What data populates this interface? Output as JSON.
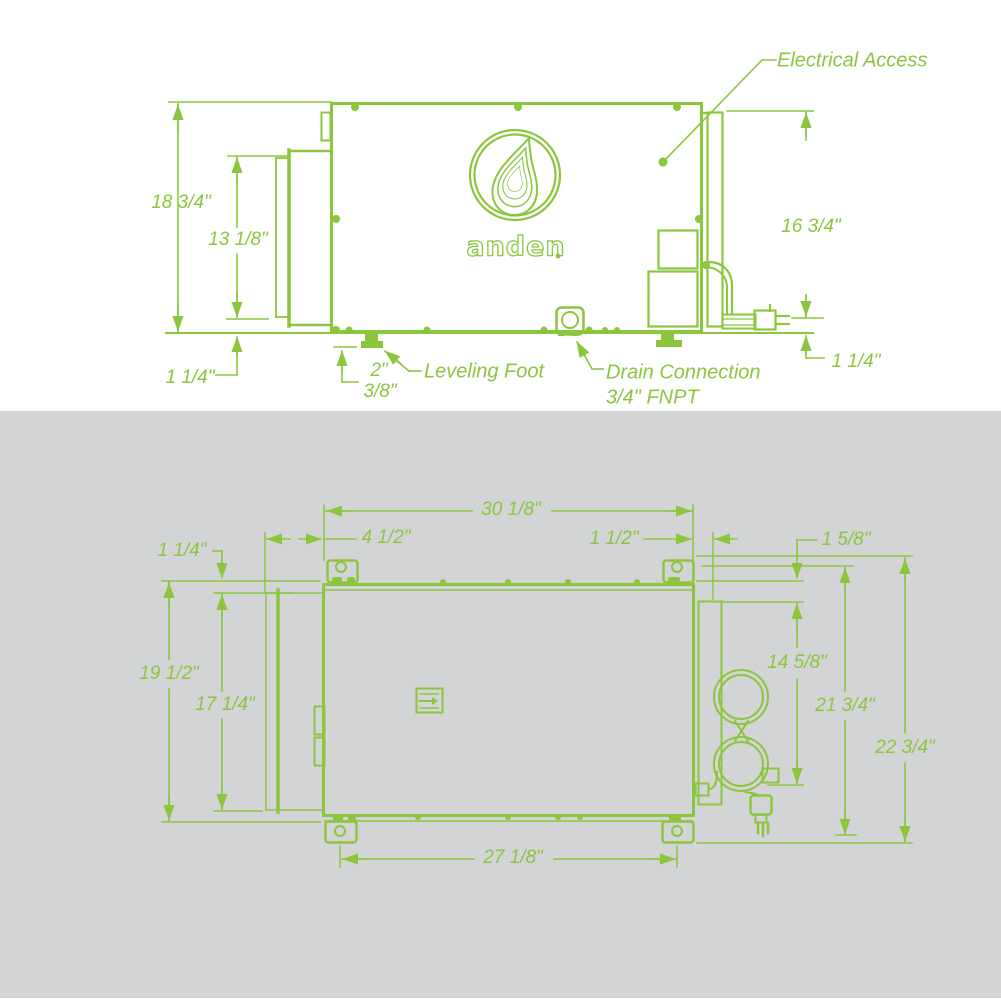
{
  "colors": {
    "line_green": "#8CC63F",
    "panel_gray": "#D2D4D6"
  },
  "brand": {
    "logo_text": "anden"
  },
  "side_view": {
    "callouts": {
      "electrical_access": "Electrical Access",
      "leveling_foot": "Leveling Foot",
      "drain_connection": "Drain Connection",
      "drain_size": "3/4\" FNPT"
    },
    "dims": {
      "overall_height": "18 3/4\"",
      "collar_height": "13 1/8\"",
      "electrical_height": "16 3/4\"",
      "clearance_left": "1 1/4\"",
      "foot_size": "2\"",
      "foot_adjust": "3/8\"",
      "clearance_right": "1 1/4\""
    }
  },
  "top_view": {
    "dims": {
      "body_width": "30 1/8\"",
      "collar_depth": "4 1/2\"",
      "panel_offset": "1 1/2\"",
      "bracket_offset_right": "1 5/8\"",
      "bracket_offset_left": "1 1/4\"",
      "body_depth": "19 1/2\"",
      "collar_width": "17 1/4\"",
      "cord_offset": "14 5/8\"",
      "depth_to_cord": "21 3/4\"",
      "overall_depth": "22 3/4\"",
      "bracket_spacing": "27 1/8\""
    }
  }
}
